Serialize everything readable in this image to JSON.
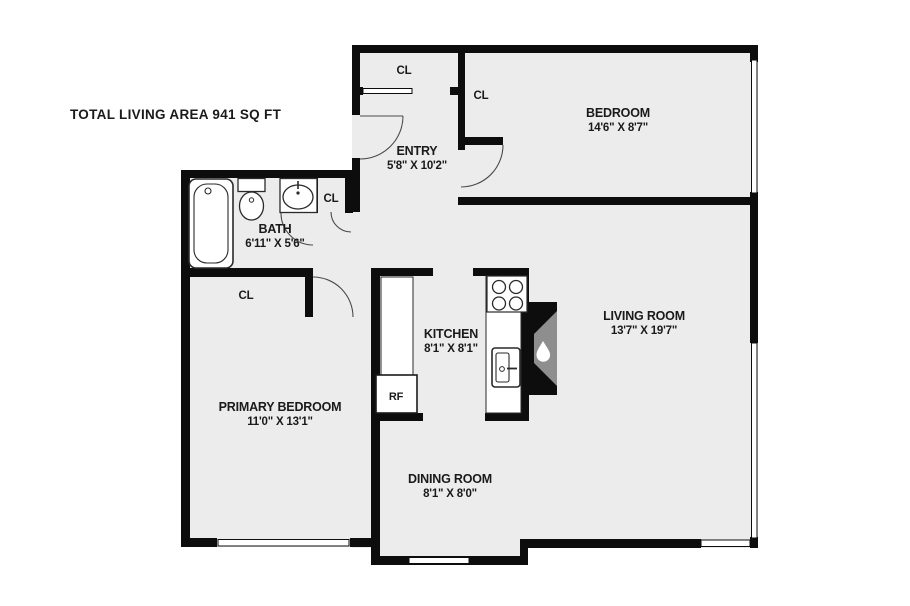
{
  "plan": {
    "title": "TOTAL LIVING AREA  941 SQ FT",
    "rooms": {
      "entry": {
        "name": "ENTRY",
        "dims": "5'8\" X 10'2\""
      },
      "bedroom": {
        "name": "BEDROOM",
        "dims": "14'6\" X 8'7\""
      },
      "bath": {
        "name": "BATH",
        "dims": "6'11\" X 5'6\""
      },
      "kitchen": {
        "name": "KITCHEN",
        "dims": "8'1\" X 8'1\""
      },
      "living": {
        "name": "LIVING ROOM",
        "dims": "13'7\" X 19'7\""
      },
      "primary": {
        "name": "PRIMARY BEDROOM",
        "dims": "11'0\" X 13'1\""
      },
      "dining": {
        "name": "DINING ROOM",
        "dims": "8'1\" X 8'0\""
      }
    },
    "labels": {
      "closet": "CL",
      "refrigerator": "RF"
    },
    "fixtures": [
      "bathtub",
      "toilet",
      "bath-sink",
      "stove",
      "kitchen-sink",
      "kitchen-counter",
      "refrigerator",
      "fireplace"
    ],
    "colors": {
      "wall": "#0d0d0d",
      "floor": "#ececec",
      "background": "#ffffff",
      "fireplace_accent": "#8e8e8e",
      "door_arc": "#4a4a4a"
    }
  }
}
